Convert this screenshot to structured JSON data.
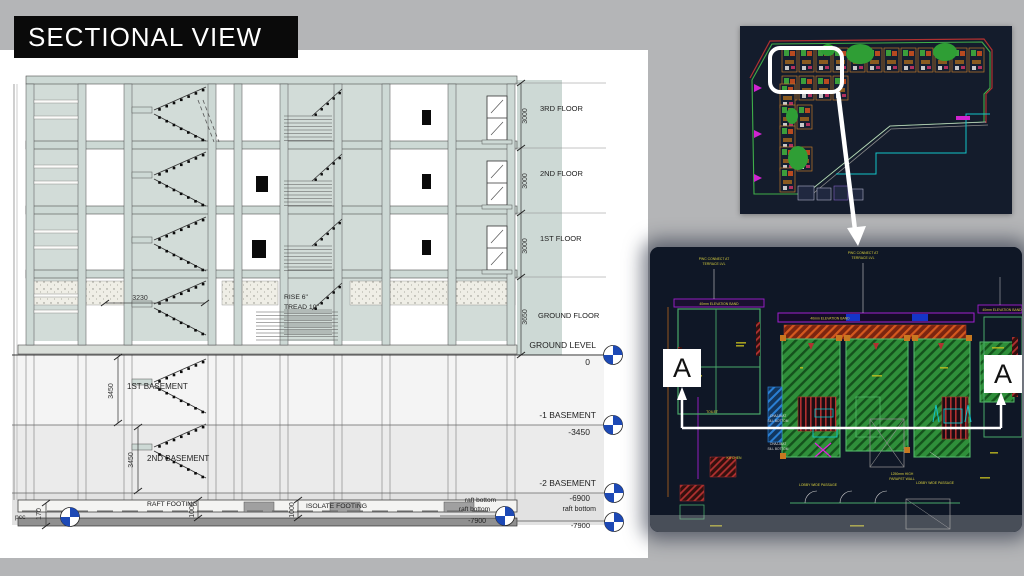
{
  "slide": {
    "title": "SECTIONAL VIEW"
  },
  "section": {
    "floor_labels": [
      "3RD FLOOR",
      "2ND FLOOR",
      "1ST FLOOR",
      "GROUND FLOOR"
    ],
    "floor_height_dim": "3000",
    "ground_floor_dim": "3650",
    "levels": [
      {
        "label": "GROUND LEVEL",
        "value": "0"
      },
      {
        "label": "-1 BASEMENT",
        "value": "-3450"
      },
      {
        "label": "-2 BASEMENT",
        "value": "-6900"
      },
      {
        "label": "raft bottom",
        "value": "-7900"
      }
    ],
    "basement_labels": [
      "1ST BASEMENT",
      "2ND BASEMENT"
    ],
    "basement_dim": "3450",
    "stair_note_line1": "RISE 6\"",
    "stair_note_line2": "TREAD 10\"",
    "stair_dim": "3230",
    "raft_footing": "RAFT FOOTING",
    "isolate_footing": "ISOLATE FOOTING",
    "raft_dim": "1000",
    "pcc": "pcc",
    "pcc_dim": "170",
    "mid_raft": {
      "line1": "raft bottom",
      "line2": "raft bottom",
      "value": "-7900"
    }
  },
  "floor_plan": {
    "section_marker": "A",
    "notes": {
      "leader_line1": "PWC CONNECT AT",
      "leader_line2": "TERRACE LVL",
      "band": "40mm ELEVATION BAND",
      "passage": "LOBBY WIDE PASSAGE",
      "parapet_line1": "1250mm HIGH",
      "parapet_line2": "PARAPET WALL",
      "chajja_line1": "CHAJJA AT",
      "chajja_line2": "SILL BOTTOM",
      "toilet": "TOILET",
      "kitchen": "KITCHEN"
    }
  },
  "colors": {
    "accent_blue": "#1d49b5",
    "cad_bg": "#121a2b",
    "teal_wall": "#cdd9d5",
    "hatch_green": "#2f8f3a",
    "magenta": "#b01bd0",
    "cyan": "#10c3c9"
  }
}
